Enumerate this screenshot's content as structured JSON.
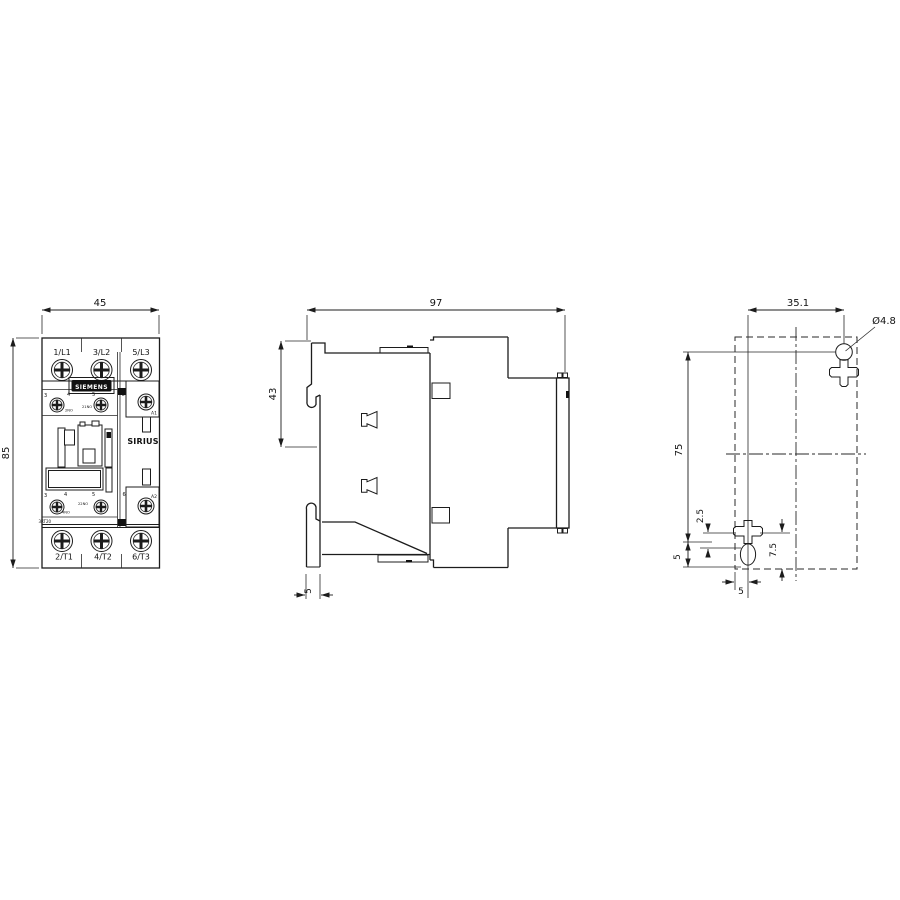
{
  "front_view": {
    "dim_width": "45",
    "dim_height": "85",
    "terminals_top": [
      "1/L1",
      "3/L2",
      "5/L3"
    ],
    "terminals_bottom": [
      "2/T1",
      "4/T2",
      "6/T3"
    ],
    "aux_top_numbers": [
      "3",
      "4",
      "5",
      "6"
    ],
    "aux_bottom_numbers": [
      "3",
      "4",
      "5",
      "6"
    ],
    "aux_top_marks": [
      "2NO",
      "21NO"
    ],
    "aux_bottom_marks": [
      "22NO",
      "4NO"
    ],
    "coil_terminal_top": "A1",
    "coil_terminal_bottom": "A2",
    "brand": "SIEMENS",
    "series": "SIRIUS",
    "type_code": "3RT20"
  },
  "side_view": {
    "dim_depth": "97",
    "dim_height": "43",
    "dim_rail_depth": "5"
  },
  "mounting_view": {
    "dim_hole_spacing_h": "35.1",
    "hole_diameter": "Ø4.8",
    "dim_hole_spacing_v": "75",
    "dim_edge_left": "5",
    "dim_slot_a": "2.5",
    "dim_slot_b": "7.5",
    "dim_edge_bottom": "5"
  },
  "colors": {
    "line": "#1c1c1c",
    "badge_bg": "#111111",
    "badge_text": "#ffffff"
  }
}
